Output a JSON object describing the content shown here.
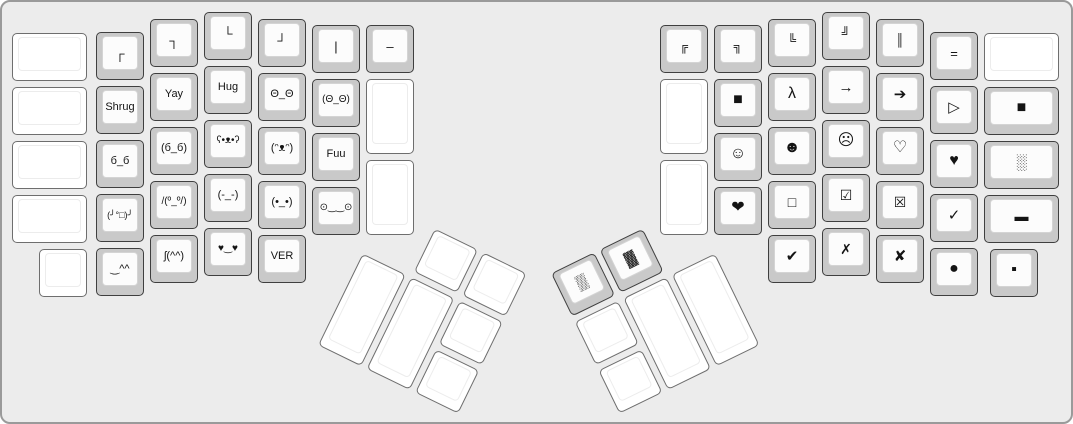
{
  "app": {
    "name": "keyboard-layout-canvas",
    "canvas_background": "#ececec",
    "key_base_color": "#c9c9c9",
    "key_top_color": "#fcfcfc",
    "blank_key_color": "#ffffff",
    "legend_color": "#141414"
  },
  "layout": {
    "unit_px": 54,
    "left_main": [
      {
        "name": "key-blank",
        "label": "",
        "x": 10,
        "y": 31,
        "w": 75,
        "h": 48
      },
      {
        "name": "key-blank",
        "label": "",
        "x": 10,
        "y": 85,
        "w": 75,
        "h": 48
      },
      {
        "name": "key-blank",
        "label": "",
        "x": 10,
        "y": 139,
        "w": 75,
        "h": 48
      },
      {
        "name": "key-blank",
        "label": "",
        "x": 10,
        "y": 193,
        "w": 75,
        "h": 48
      },
      {
        "name": "key-blank",
        "label": "",
        "x": 37,
        "y": 247,
        "w": 48,
        "h": 48
      },
      {
        "name": "key-corner-top-left",
        "label": "┌",
        "x": 94,
        "y": 30,
        "w": 48,
        "h": 48,
        "fs": 13
      },
      {
        "name": "key-shrug",
        "label": "Shrug",
        "x": 94,
        "y": 84,
        "w": 48,
        "h": 48,
        "fs": 11
      },
      {
        "name": "key-squint-face",
        "label": "б_б",
        "x": 94,
        "y": 138,
        "w": 48,
        "h": 48,
        "fs": 11
      },
      {
        "name": "key-table-flip",
        "label": "(╯°□)╯",
        "x": 94,
        "y": 192,
        "w": 48,
        "h": 48,
        "fs": 9
      },
      {
        "name": "key-smile-carets",
        "label": "‿^^",
        "x": 94,
        "y": 246,
        "w": 48,
        "h": 48,
        "fs": 11
      },
      {
        "name": "key-corner-top-right",
        "label": "┐",
        "x": 148,
        "y": 17,
        "w": 48,
        "h": 48,
        "fs": 13
      },
      {
        "name": "key-yay",
        "label": "Yay",
        "x": 148,
        "y": 71,
        "w": 48,
        "h": 48,
        "fs": 11
      },
      {
        "name": "key-squint-face-parens",
        "label": "(б_б)",
        "x": 148,
        "y": 125,
        "w": 48,
        "h": 48,
        "fs": 11
      },
      {
        "name": "key-table-unflip",
        "label": "/(º_º/)",
        "x": 148,
        "y": 179,
        "w": 48,
        "h": 48,
        "fs": 10
      },
      {
        "name": "key-shrug-face",
        "label": "ʃ(^^)",
        "x": 148,
        "y": 233,
        "w": 48,
        "h": 48,
        "fs": 11
      },
      {
        "name": "key-corner-bottom-left",
        "label": "└",
        "x": 202,
        "y": 10,
        "w": 48,
        "h": 48,
        "fs": 13
      },
      {
        "name": "key-hug",
        "label": "Hug",
        "x": 202,
        "y": 64,
        "w": 48,
        "h": 48,
        "fs": 11
      },
      {
        "name": "key-bear-face",
        "label": "ʕ•ᴥ•ʔ",
        "x": 202,
        "y": 118,
        "w": 48,
        "h": 48,
        "fs": 10
      },
      {
        "name": "key-annoyed-face",
        "label": "(-_-)",
        "x": 202,
        "y": 172,
        "w": 48,
        "h": 48,
        "fs": 11
      },
      {
        "name": "key-heart-eyes",
        "label": "♥‿♥",
        "x": 202,
        "y": 226,
        "w": 48,
        "h": 48,
        "fs": 10
      },
      {
        "name": "key-corner-bottom-right",
        "label": "┘",
        "x": 256,
        "y": 17,
        "w": 48,
        "h": 48,
        "fs": 13
      },
      {
        "name": "key-stare-face",
        "label": "Θ_Θ",
        "x": 256,
        "y": 71,
        "w": 48,
        "h": 48,
        "fs": 11
      },
      {
        "name": "key-happy-bear",
        "label": "(ᵔᴥᵔ)",
        "x": 256,
        "y": 125,
        "w": 48,
        "h": 48,
        "fs": 11
      },
      {
        "name": "key-neutral-face",
        "label": "(•_•)",
        "x": 256,
        "y": 179,
        "w": 48,
        "h": 48,
        "fs": 11
      },
      {
        "name": "key-version",
        "label": "VER",
        "x": 256,
        "y": 233,
        "w": 48,
        "h": 48,
        "fs": 11
      },
      {
        "name": "key-vertical-bar",
        "label": "|",
        "x": 310,
        "y": 23,
        "w": 48,
        "h": 48,
        "fs": 13
      },
      {
        "name": "key-stare-face-parens",
        "label": "(Θ_Θ)",
        "x": 310,
        "y": 77,
        "w": 48,
        "h": 48,
        "fs": 10
      },
      {
        "name": "key-fuu",
        "label": "Fuu",
        "x": 310,
        "y": 131,
        "w": 48,
        "h": 48,
        "fs": 11
      },
      {
        "name": "key-worried-face",
        "label": "⊙‿‿⊙",
        "x": 310,
        "y": 185,
        "w": 48,
        "h": 48,
        "fs": 10
      },
      {
        "name": "key-dash",
        "label": "–",
        "x": 364,
        "y": 23,
        "w": 48,
        "h": 48,
        "fs": 13
      },
      {
        "name": "key-blank",
        "label": "",
        "x": 364,
        "y": 77,
        "w": 48,
        "h": 75
      },
      {
        "name": "key-blank",
        "label": "",
        "x": 364,
        "y": 158,
        "w": 48,
        "h": 75
      }
    ],
    "right_main": [
      {
        "name": "key-double-corner-top-left",
        "label": "╔",
        "x": 658,
        "y": 23,
        "w": 48,
        "h": 48,
        "fs": 12
      },
      {
        "name": "key-blank",
        "label": "",
        "x": 658,
        "y": 77,
        "w": 48,
        "h": 75
      },
      {
        "name": "key-blank",
        "label": "",
        "x": 658,
        "y": 158,
        "w": 48,
        "h": 75
      },
      {
        "name": "key-double-corner-top-right",
        "label": "╗",
        "x": 712,
        "y": 23,
        "w": 48,
        "h": 48,
        "fs": 12
      },
      {
        "name": "key-black-square",
        "label": "■",
        "x": 712,
        "y": 77,
        "w": 48,
        "h": 48,
        "fs": 16
      },
      {
        "name": "key-smiley-white",
        "label": "☺",
        "x": 712,
        "y": 131,
        "w": 48,
        "h": 48,
        "fs": 16
      },
      {
        "name": "key-heart-heavy",
        "label": "❤",
        "x": 712,
        "y": 185,
        "w": 48,
        "h": 48,
        "fs": 16
      },
      {
        "name": "key-double-corner-bottom-left",
        "label": "╚",
        "x": 766,
        "y": 17,
        "w": 48,
        "h": 48,
        "fs": 12
      },
      {
        "name": "key-lambda",
        "label": "λ",
        "x": 766,
        "y": 71,
        "w": 48,
        "h": 48,
        "fs": 16
      },
      {
        "name": "key-smiley-black",
        "label": "☻",
        "x": 766,
        "y": 125,
        "w": 48,
        "h": 48,
        "fs": 16
      },
      {
        "name": "key-square-white",
        "label": "□",
        "x": 766,
        "y": 179,
        "w": 48,
        "h": 48,
        "fs": 14
      },
      {
        "name": "key-check-heavy",
        "label": "✔",
        "x": 766,
        "y": 233,
        "w": 48,
        "h": 48,
        "fs": 15
      },
      {
        "name": "key-double-corner-bottom-right",
        "label": "╝",
        "x": 820,
        "y": 10,
        "w": 48,
        "h": 48,
        "fs": 12
      },
      {
        "name": "key-arrow-right",
        "label": "→",
        "x": 820,
        "y": 64,
        "w": 48,
        "h": 48,
        "fs": 15
      },
      {
        "name": "key-frown-face",
        "label": "☹",
        "x": 820,
        "y": 118,
        "w": 48,
        "h": 48,
        "fs": 16
      },
      {
        "name": "key-checkbox-checked",
        "label": "☑",
        "x": 820,
        "y": 172,
        "w": 48,
        "h": 48,
        "fs": 14
      },
      {
        "name": "key-ballot-x",
        "label": "✗",
        "x": 820,
        "y": 226,
        "w": 48,
        "h": 48,
        "fs": 14
      },
      {
        "name": "key-double-vertical",
        "label": "║",
        "x": 874,
        "y": 17,
        "w": 48,
        "h": 48,
        "fs": 12
      },
      {
        "name": "key-arrow-right-heavy",
        "label": "➔",
        "x": 874,
        "y": 71,
        "w": 48,
        "h": 48,
        "fs": 15
      },
      {
        "name": "key-heart-white",
        "label": "♡",
        "x": 874,
        "y": 125,
        "w": 48,
        "h": 48,
        "fs": 16
      },
      {
        "name": "key-checkbox-x",
        "label": "☒",
        "x": 874,
        "y": 179,
        "w": 48,
        "h": 48,
        "fs": 14
      },
      {
        "name": "key-x-heavy",
        "label": "✘",
        "x": 874,
        "y": 233,
        "w": 48,
        "h": 48,
        "fs": 15
      },
      {
        "name": "key-equals",
        "label": "=",
        "x": 928,
        "y": 30,
        "w": 48,
        "h": 48,
        "fs": 13
      },
      {
        "name": "key-triangle-right",
        "label": "▷",
        "x": 928,
        "y": 84,
        "w": 48,
        "h": 48,
        "fs": 15
      },
      {
        "name": "key-heart-black",
        "label": "♥",
        "x": 928,
        "y": 138,
        "w": 48,
        "h": 48,
        "fs": 16
      },
      {
        "name": "key-check",
        "label": "✓",
        "x": 928,
        "y": 192,
        "w": 48,
        "h": 48,
        "fs": 15
      },
      {
        "name": "key-circle-black",
        "label": "●",
        "x": 928,
        "y": 246,
        "w": 48,
        "h": 48,
        "fs": 16
      },
      {
        "name": "key-blank",
        "label": "",
        "x": 982,
        "y": 31,
        "w": 75,
        "h": 48
      },
      {
        "name": "key-black-square-2",
        "label": "■",
        "x": 982,
        "y": 85,
        "w": 75,
        "h": 48,
        "fs": 16
      },
      {
        "name": "key-shade-light",
        "label": "░",
        "x": 982,
        "y": 139,
        "w": 75,
        "h": 48,
        "fs": 15
      },
      {
        "name": "key-rectangle-black",
        "label": "▬",
        "x": 982,
        "y": 193,
        "w": 75,
        "h": 48,
        "fs": 14
      },
      {
        "name": "key-square-small-black",
        "label": "▪",
        "x": 988,
        "y": 247,
        "w": 48,
        "h": 48,
        "fs": 16
      }
    ],
    "left_thumb": {
      "x": 383,
      "y": 199,
      "rotation_deg": 26,
      "keys": [
        {
          "name": "key-blank",
          "label": "",
          "x": 57,
          "y": 3,
          "w": 48,
          "h": 48
        },
        {
          "name": "key-blank",
          "label": "",
          "x": 111,
          "y": 3,
          "w": 48,
          "h": 48
        },
        {
          "name": "key-blank",
          "label": "",
          "x": 3,
          "y": 57,
          "w": 48,
          "h": 102
        },
        {
          "name": "key-blank",
          "label": "",
          "x": 57,
          "y": 57,
          "w": 48,
          "h": 102
        },
        {
          "name": "key-blank",
          "label": "",
          "x": 111,
          "y": 57,
          "w": 48,
          "h": 48
        },
        {
          "name": "key-blank",
          "label": "",
          "x": 111,
          "y": 111,
          "w": 48,
          "h": 48
        }
      ]
    },
    "right_thumb": {
      "x": 545,
      "y": 270,
      "rotation_deg": -26,
      "keys": [
        {
          "name": "key-shade-medium",
          "label": "▒",
          "x": 3,
          "y": 3,
          "w": 48,
          "h": 48,
          "fs": 15
        },
        {
          "name": "key-shade-dark",
          "label": "▓",
          "x": 57,
          "y": 3,
          "w": 48,
          "h": 48,
          "fs": 15
        },
        {
          "name": "key-blank",
          "label": "",
          "x": 3,
          "y": 57,
          "w": 48,
          "h": 48
        },
        {
          "name": "key-blank",
          "label": "",
          "x": 57,
          "y": 57,
          "w": 48,
          "h": 102
        },
        {
          "name": "key-blank",
          "label": "",
          "x": 111,
          "y": 57,
          "w": 48,
          "h": 102
        },
        {
          "name": "key-blank",
          "label": "",
          "x": 3,
          "y": 111,
          "w": 48,
          "h": 48
        }
      ]
    }
  }
}
